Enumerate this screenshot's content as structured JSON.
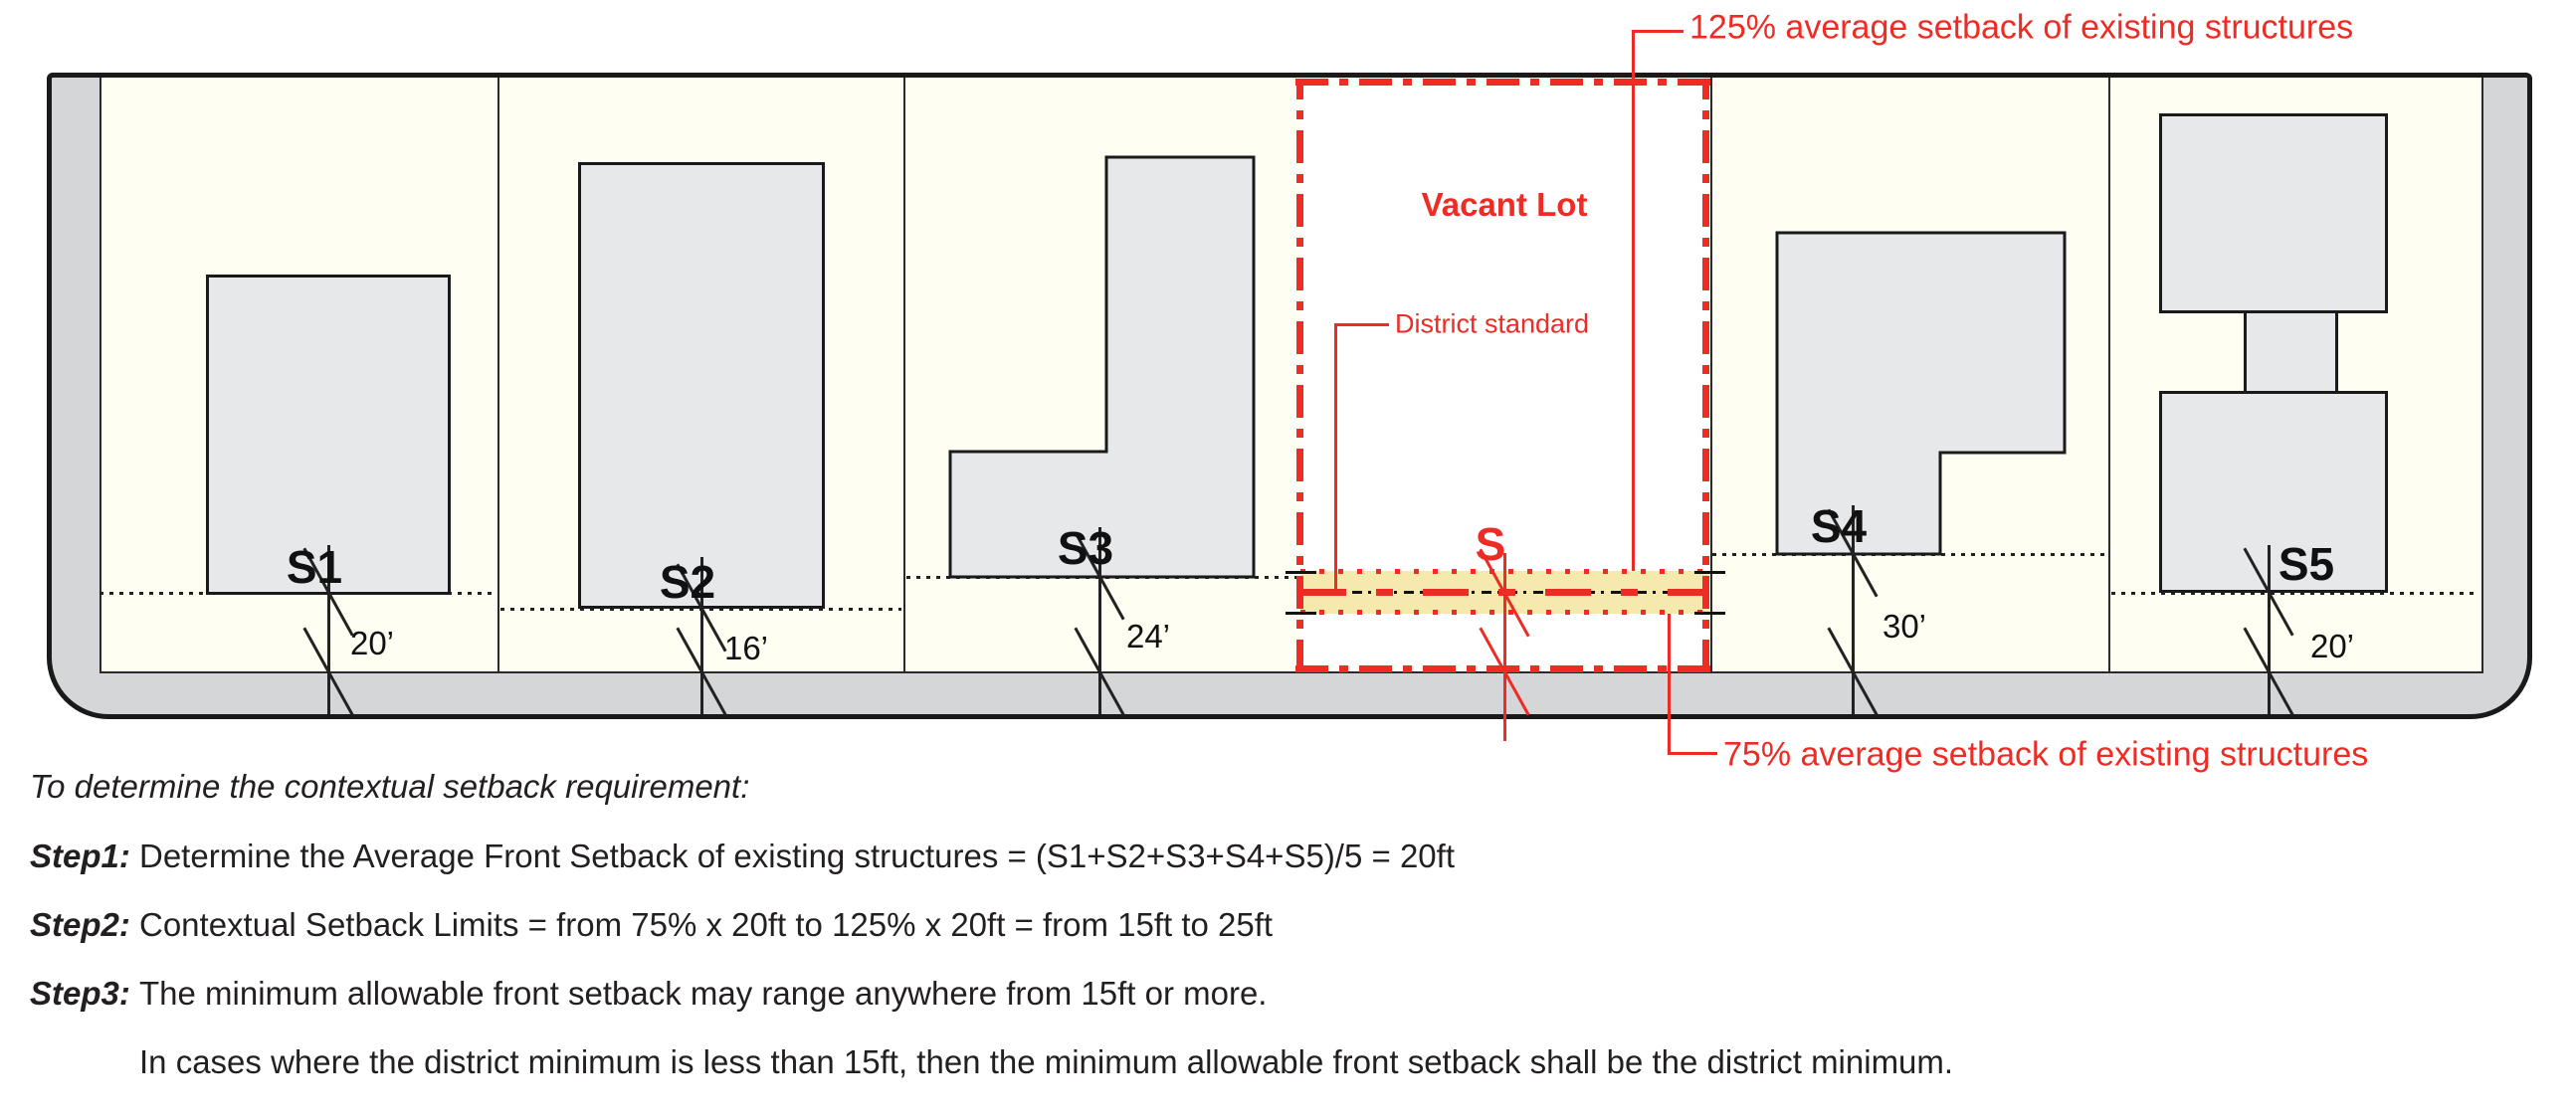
{
  "diagram": {
    "vacant_lot_label": "Vacant Lot",
    "district_standard_label": "District standard",
    "top_annotation": "125% average setback of existing structures",
    "bottom_annotation": "75% average setback of existing structures",
    "vacant_setback_label": "S",
    "lots": [
      {
        "label": "S1",
        "setback": "20’"
      },
      {
        "label": "S2",
        "setback": "16’"
      },
      {
        "label": "S3",
        "setback": "24’"
      },
      {
        "label": "S4",
        "setback": "30’"
      },
      {
        "label": "S5",
        "setback": "20’"
      }
    ],
    "colors": {
      "annotation_red": "#EE2B24",
      "highlight_band_yellow": "#F6E9AE",
      "building_gray": "#E7E8E9",
      "street_gray": "#D5D6D7",
      "lot_cream": "#FFFEF2"
    }
  },
  "notes": {
    "intro": "To determine the contextual setback requirement:",
    "steps": [
      {
        "label": "Step1:",
        "text": "Determine the Average Front Setback of existing structures = (S1+S2+S3+S4+S5)/5 = 20ft"
      },
      {
        "label": "Step2:",
        "text": "Contextual Setback Limits = from 75% x 20ft to 125% x 20ft = from 15ft to 25ft"
      },
      {
        "label": "Step3:",
        "text": "The minimum allowable front setback may range anywhere from 15ft or more."
      },
      {
        "label": "",
        "text": "In cases where the district minimum is less than 15ft, then the minimum allowable front setback shall be the district minimum."
      }
    ]
  }
}
